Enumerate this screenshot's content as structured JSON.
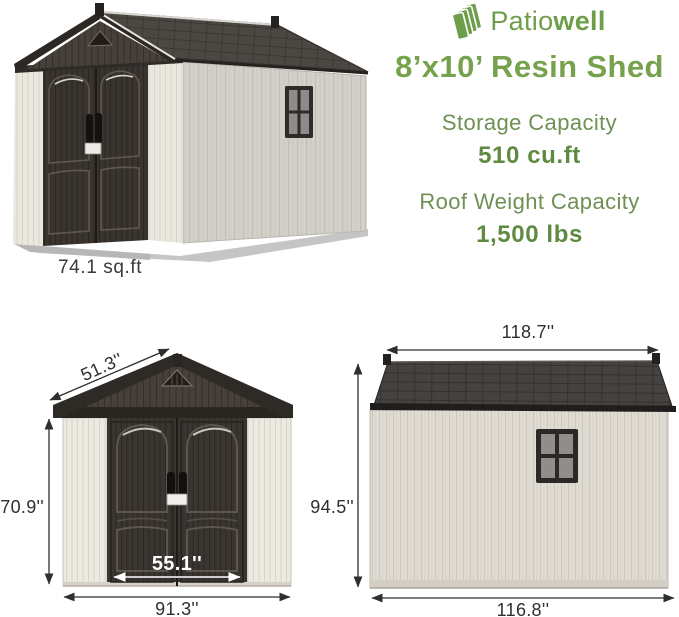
{
  "brand": {
    "name_regular": "Patio",
    "name_bold": "well",
    "logo_color": "#6f9e4a"
  },
  "headline": {
    "title": "8’x10’ Resin Shed"
  },
  "specs": [
    {
      "label": "Storage Capacity",
      "value": "510 cu.ft"
    },
    {
      "label": "Roof Weight Capacity",
      "value": "1,500 lbs"
    }
  ],
  "perspective_view": {
    "floor_area_label": "74.1 sq.ft"
  },
  "front_view": {
    "roof_width": "51.3''",
    "wall_height": "70.9''",
    "door_width": "55.1''",
    "total_width": "91.3''"
  },
  "side_view": {
    "roof_length": "118.7''",
    "total_height": "94.5''",
    "wall_length": "116.8''"
  },
  "colors": {
    "brand_green": "#76a24d",
    "spec_green": "#6f9054",
    "dim_text": "#2f2f2f",
    "roof_dark": "#45423f",
    "door_dark": "#3a3530",
    "wall_cream": "#ece9e1",
    "wall_gray": "#d9d6cf"
  }
}
